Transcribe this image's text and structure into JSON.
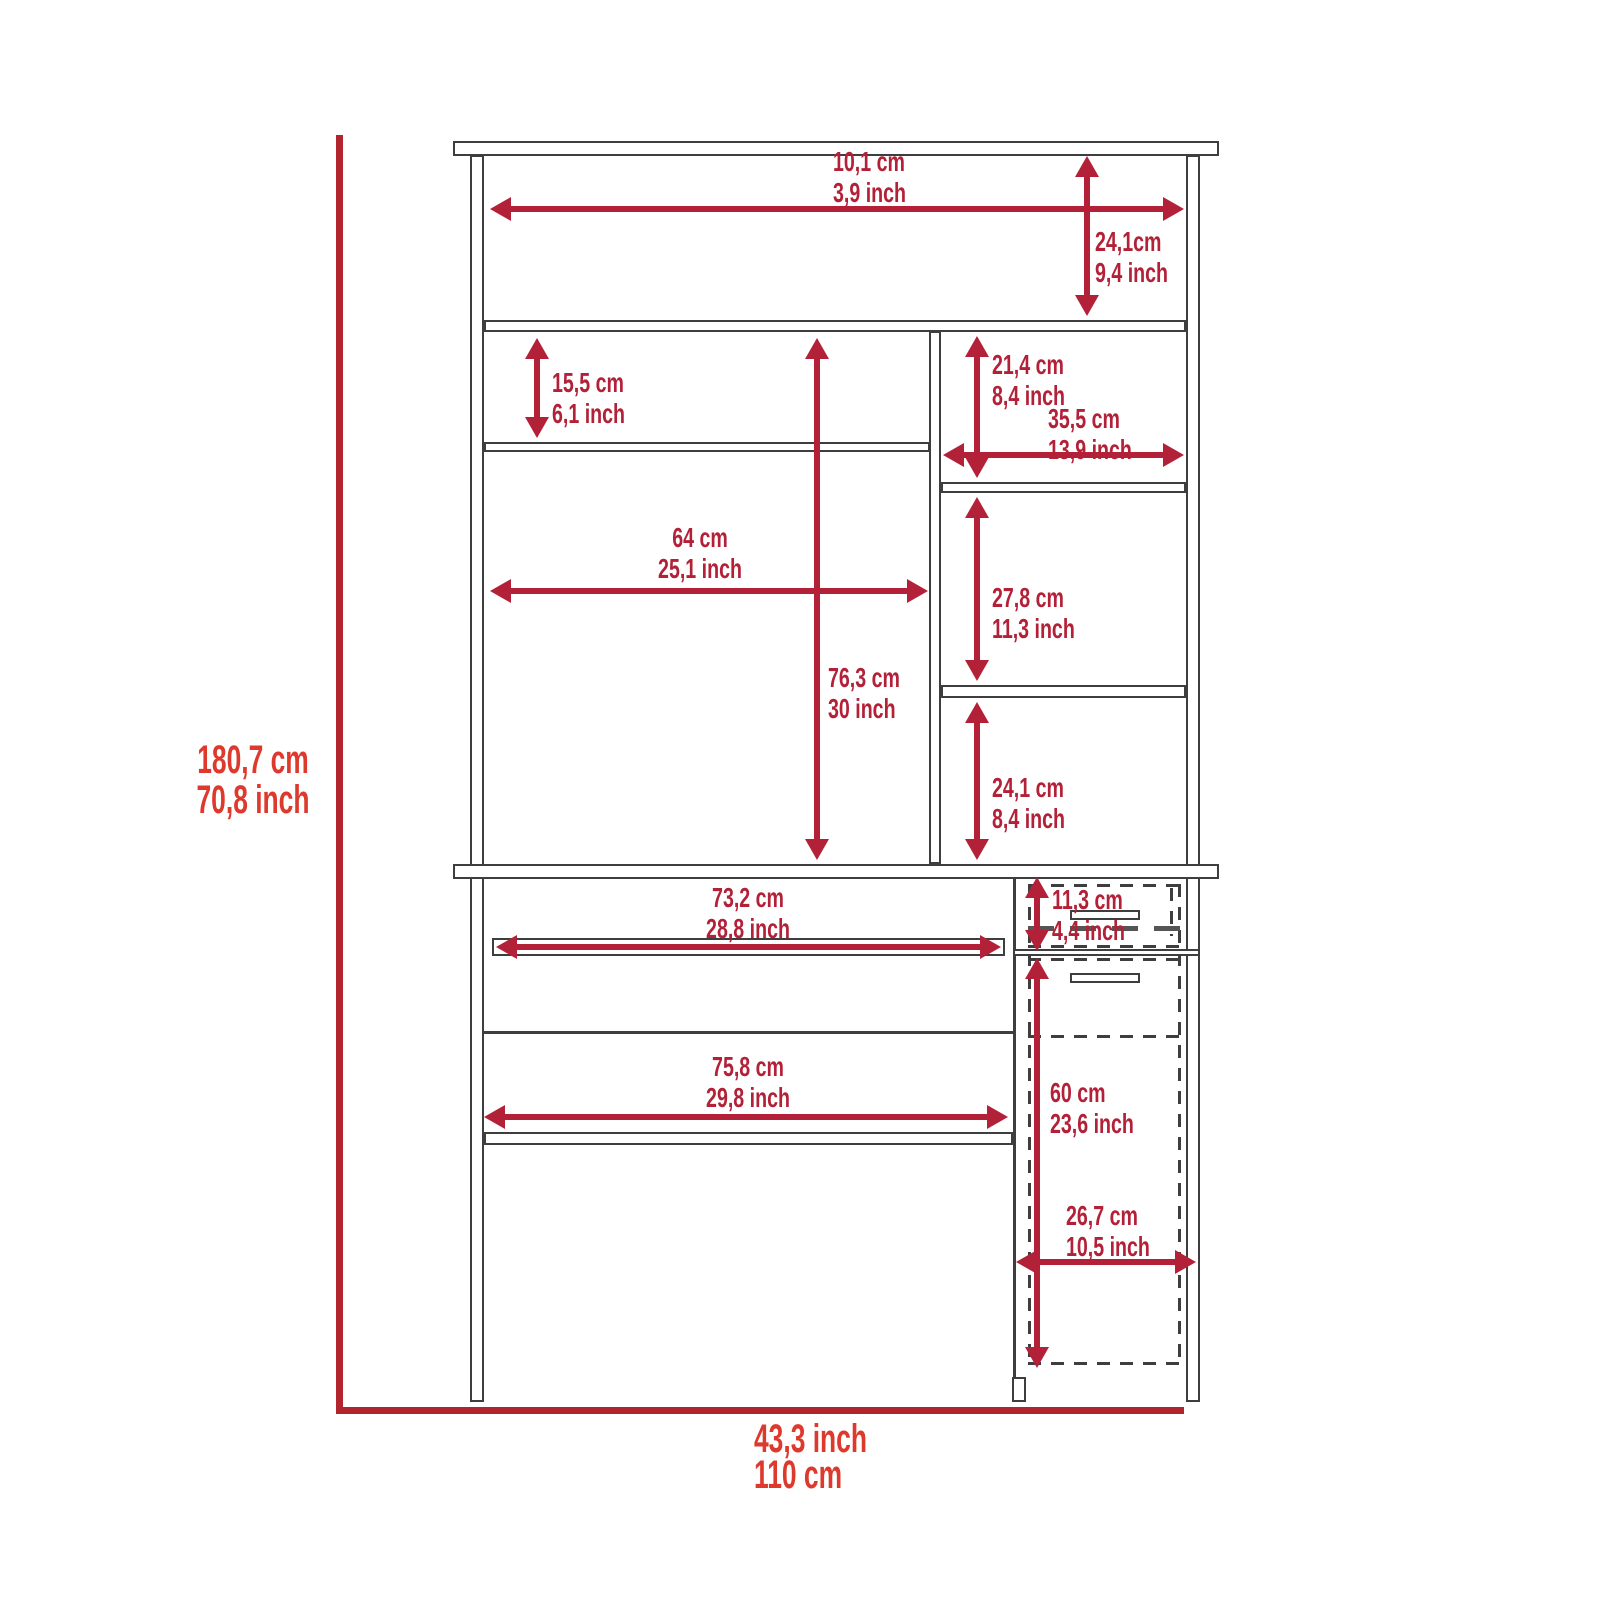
{
  "diagram": {
    "overall_height": {
      "metric": "180,7 cm",
      "imperial": "70,8 inch"
    },
    "overall_width": {
      "imperial": "43,3 inch",
      "metric": "110 cm"
    },
    "hutch": {
      "top_shelf_width": {
        "metric": "10,1 cm",
        "imperial": "3,9 inch"
      },
      "top_cubby_height": {
        "metric": "24,1cm",
        "imperial": "9,4 inch"
      },
      "left_cubby_height": {
        "metric": "15,5 cm",
        "imperial": "6,1 inch"
      },
      "left_section_width": {
        "metric": "64 cm",
        "imperial": "25,1 inch"
      },
      "interior_height": {
        "metric": "76,3 cm",
        "imperial": "30 inch"
      },
      "right_top_cubby_height": {
        "metric": "21,4 cm",
        "imperial": "8,4 inch"
      },
      "right_section_width": {
        "metric": "35,5 cm",
        "imperial": "13,9 inch"
      },
      "right_middle_cubby_height": {
        "metric": "27,8 cm",
        "imperial": "11,3 inch"
      },
      "right_bottom_cubby_height": {
        "metric": "24,1 cm",
        "imperial": "8,4 inch"
      }
    },
    "desk": {
      "keyboard_tray_width": {
        "metric": "73,2 cm",
        "imperial": "28,8 inch"
      },
      "drawer_height": {
        "metric": "11,3 cm",
        "imperial": "4,4 inch"
      },
      "opening_width": {
        "metric": "75,8 cm",
        "imperial": "29,8 inch"
      },
      "cabinet_height": {
        "metric": "60 cm",
        "imperial": "23,6 inch"
      },
      "cabinet_width": {
        "metric": "26,7 cm",
        "imperial": "10,5 inch"
      }
    },
    "colors": {
      "dimension_red": "#b32138",
      "outer_label_red": "#de392d",
      "frame_line_red": "#b2252f",
      "outline_gray": "#3e3e3e"
    }
  }
}
